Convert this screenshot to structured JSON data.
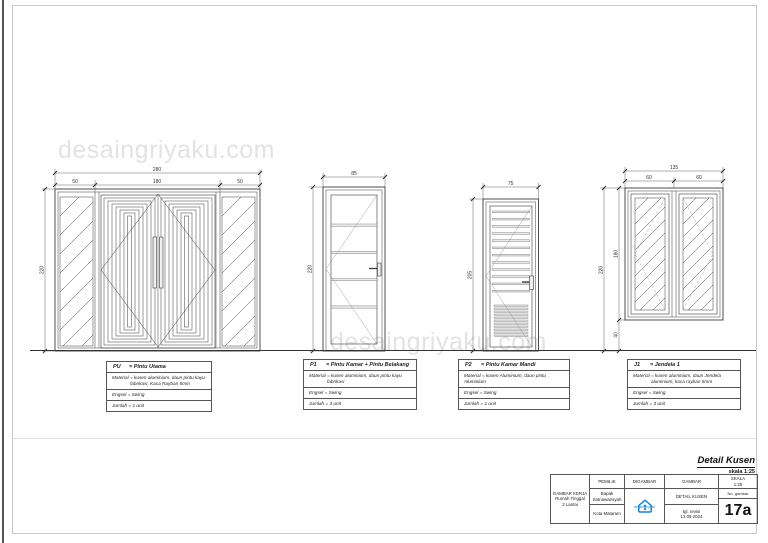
{
  "watermark": {
    "text": "desaingriyaku.com"
  },
  "colors": {
    "logo_blue": "#1a86d0",
    "watermark_gray": "#e3e3e3",
    "line_dark": "#3c3c3c"
  },
  "dims": {
    "pu": {
      "total": "280",
      "seg1": "50",
      "seg2": "180",
      "seg3": "50",
      "height": "220"
    },
    "p1": {
      "width": "85",
      "height": "220"
    },
    "p2": {
      "width": "75",
      "height": "205"
    },
    "j1": {
      "total": "135",
      "left": "60",
      "right": "60",
      "height_total": "220",
      "height_window": "180",
      "height_sill": "40"
    }
  },
  "labels": {
    "pu": {
      "code": "PU",
      "name": "= Pintu Utama",
      "material_1": "Material = kusen aluminium, daun pintu kayu",
      "material_2": "fabrikasi, Kaca Rayban 5mm",
      "engsel": "Engsel  = Swing",
      "jumlah": "Jumlah  = 1 unit"
    },
    "p1": {
      "code": "P1",
      "name": "= Pintu Kamar + Pintu Belakang",
      "material_1": "Material = kusen aluminium, daun pintu kayu",
      "material_2": "fabrikasi",
      "engsel": "Engsel  = Swing",
      "jumlah": "Jumlah  = 3 unit"
    },
    "p2": {
      "code": "P2",
      "name": "= Pintu Kamar Mandi",
      "material_1": "Material = kusen Aluminium, daun pintu Aluminium",
      "engsel": "Engsel  = Swing",
      "jumlah": "Jumlah  = 1 unit"
    },
    "j1": {
      "code": "J1",
      "name": "= Jendela 1",
      "material_1": "Material = kusen aluminium, daun Jendela",
      "material_2": "aluminium, kaca rayban 5mm",
      "engsel": "Engsel  = Swing",
      "jumlah": "Jumlah  = 3 unit"
    }
  },
  "title_block": {
    "title": "Detail Kusen",
    "scale_note": "skala 1:25",
    "project": {
      "line1": "GAMBAR KERJA",
      "line2": "Rumah Tinggal",
      "line3": "2 Lantai"
    },
    "pemilik": {
      "header": "PEMILIK",
      "name_1": "Bapak",
      "name_2": "Satriawansyah",
      "city": "Kota Mataram"
    },
    "digambar": {
      "header": "DIGAMBAR",
      "logo_text": "desaingriyaku"
    },
    "gambar": {
      "header": "GAMBAR",
      "name": "DETAIL KUSEN",
      "revisi_1": "tgl. revisi",
      "revisi_2": "13 09 2024"
    },
    "skala": {
      "header": "SKALA",
      "value": "1:25",
      "no_label": "No. gambar",
      "number": "17a"
    }
  }
}
